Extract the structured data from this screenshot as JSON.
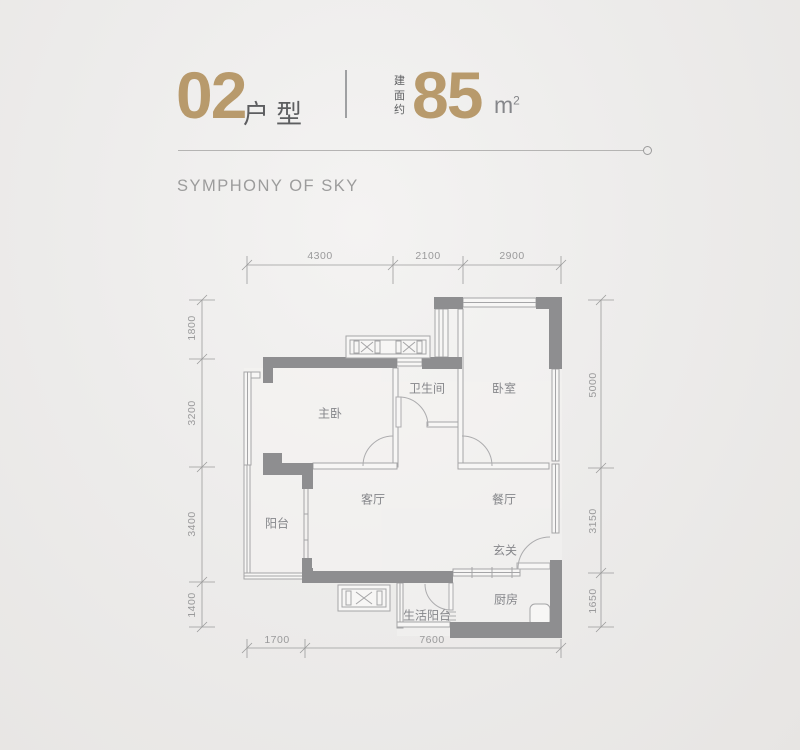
{
  "header": {
    "unit_number": "02",
    "unit_type_label": "户型",
    "area_prefix_chars": {
      "c1": "建",
      "c2": "面",
      "c3": "约"
    },
    "area_value": "85",
    "area_unit_base": "m",
    "area_unit_sup": "2",
    "subtitle": "SYMPHONY OF SKY"
  },
  "floorplan": {
    "rooms": {
      "master_bedroom": "主卧",
      "bathroom": "卫生间",
      "bedroom": "卧室",
      "balcony": "阳台",
      "living_room": "客厅",
      "dining_room": "餐厅",
      "foyer": "玄关",
      "kitchen": "厨房",
      "utility_balcony": "生活阳台"
    },
    "dimensions_mm": {
      "top": [
        "4300",
        "2100",
        "2900"
      ],
      "left": [
        "1800",
        "3200",
        "3400",
        "1400"
      ],
      "right": [
        "5000",
        "3150",
        "1650"
      ],
      "bottom": [
        "1700",
        "7600"
      ]
    },
    "colors": {
      "accent_gold": "#b89a6c",
      "wall_gray": "#8e8e90",
      "thin_line_gray": "#a5a5a7",
      "dim_line_gray": "#9b9b9b",
      "room_text_gray": "#85868a"
    }
  }
}
